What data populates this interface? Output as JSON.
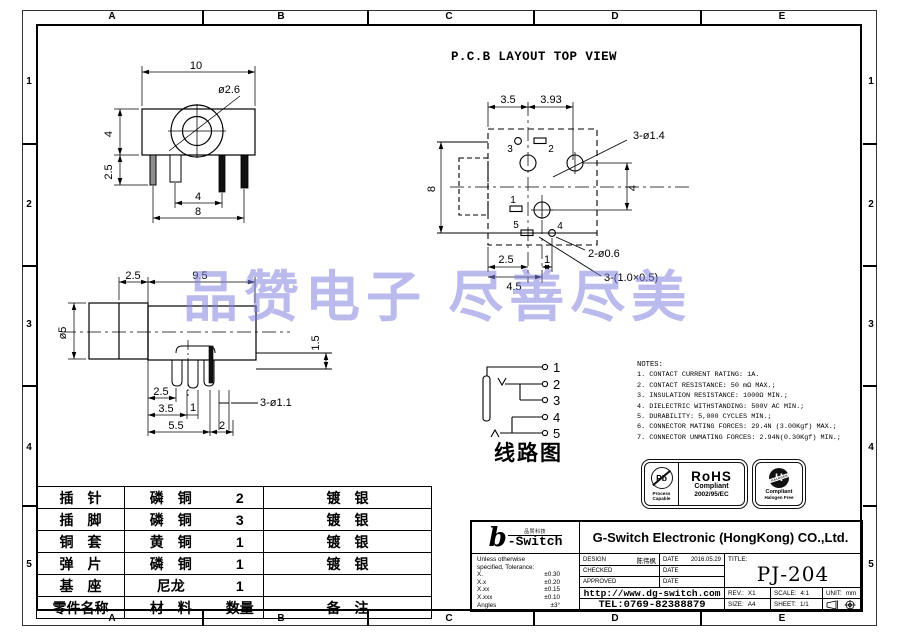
{
  "border": {
    "cols": [
      "A",
      "B",
      "C",
      "D",
      "E"
    ],
    "rows": [
      "1",
      "2",
      "3",
      "4",
      "5"
    ]
  },
  "watermark": {
    "text": "品赞电子 尽善尽美",
    "color": "#8282e0"
  },
  "pcb_title": "P.C.B LAYOUT  TOP VIEW",
  "front_view": {
    "w10": "10",
    "hole": "ø2.6",
    "h4": "4",
    "pin25": "2.5",
    "pitch4": "4",
    "w8": "8"
  },
  "pcb_view": {
    "t35": "3.5",
    "t393": "3.93",
    "l8": "8",
    "r4": "4",
    "b25": "2.5",
    "b1": "1",
    "b45": "4.5",
    "holes14": "3-ø1.4",
    "holes06": "2-ø0.6",
    "slots": "3-(1.0×0.5)",
    "pins": [
      "1",
      "2",
      "3",
      "4",
      "5"
    ]
  },
  "side_view": {
    "t25": "2.5",
    "t95": "9.5",
    "dia5": "ø5",
    "r15": "1.5",
    "b25": "2.5",
    "b35": "3.5",
    "b1": "1",
    "b55": "5.5",
    "b2": "2",
    "holes": "3-ø1.1"
  },
  "schematic": {
    "caption": "线路图",
    "pins": [
      "1",
      "2",
      "3",
      "4",
      "5"
    ]
  },
  "notes": {
    "title": "NOTES:",
    "items": [
      "1. CONTACT CURRENT RATING: 1A.",
      "2. CONTACT RESISTANCE: 50 mΩ MAX.;",
      "3. INSULATION RESISTANCE: 1000Ω MIN.;",
      "4. DIELECTRIC WITHSTANDING: 500V AC MIN.;",
      "5. DURABILITY: 5,000 CYCLES MIN.;",
      "6. CONNECTOR MATING FORCES: 29.4N (3.00Kgf) MAX.;",
      "7. CONNECTOR UNMATING FORCES: 2.94N(0.30Kgf) MIN.;"
    ]
  },
  "badges": {
    "pb_symbol": "Pb",
    "pb_cap1": "Process",
    "pb_cap2": "Capable",
    "rohs_title": "RoHS",
    "rohs_l1": "Compliant",
    "rohs_l2": "2002/95/EC",
    "hal_symbol": "H",
    "hal_band": "HALOGEN",
    "hal_l1": "Compliant",
    "hal_l2": "Halogen Free"
  },
  "parts_table": {
    "rows": [
      {
        "name": "插　针",
        "material": "磷　铜",
        "qty": "2",
        "remark": "镀　银"
      },
      {
        "name": "插　脚",
        "material": "磷　铜",
        "qty": "3",
        "remark": "镀　银"
      },
      {
        "name": "铜　套",
        "material": "黄　铜",
        "qty": "1",
        "remark": "镀　银"
      },
      {
        "name": "弹　片",
        "material": "磷　铜",
        "qty": "1",
        "remark": "镀　银"
      },
      {
        "name": "基　座",
        "material": "尼龙",
        "qty": "1",
        "remark": ""
      }
    ],
    "footer": {
      "name": "零件名称",
      "material": "材　料",
      "qty": "数量",
      "remark": "备　注"
    }
  },
  "title_block": {
    "logo_b": "b",
    "logo_small": "品赞科技",
    "logo_switch": "-Switch",
    "company": "G-Switch Electronic (HongKong) CO.,Ltd.",
    "tol_line1": "Unless otherwise",
    "tol_line2": "specified, Tolerance:",
    "tol": [
      {
        "label": "X.",
        "value": "±0.30"
      },
      {
        "label": "X.x",
        "value": "±0.20"
      },
      {
        "label": "X.xx",
        "value": "±0.15"
      },
      {
        "label": "X.xxx",
        "value": "±0.10"
      },
      {
        "label": "Angles",
        "value": "±3°"
      }
    ],
    "design_label": "DESIGN",
    "design_name": "陈伟枫",
    "date_label": "DATE",
    "design_date": "2016.05.29",
    "checked_label": "CHECKED",
    "approved_label": "APPROVED",
    "url": "http://www.dg-switch.com",
    "tel": "TEL:0769-82388879",
    "title_label": "TITLE:",
    "title_value": "PJ-204",
    "rev_label": "REV.:",
    "rev_value": "X1",
    "scale_label": "SCALE:",
    "scale_value": "4:1",
    "unit_label": "UNIT:",
    "unit_value": "mm",
    "size_label": "SIZE:",
    "size_value": "A4",
    "sheet_label": "SHEET:",
    "sheet_value": "1/1"
  }
}
